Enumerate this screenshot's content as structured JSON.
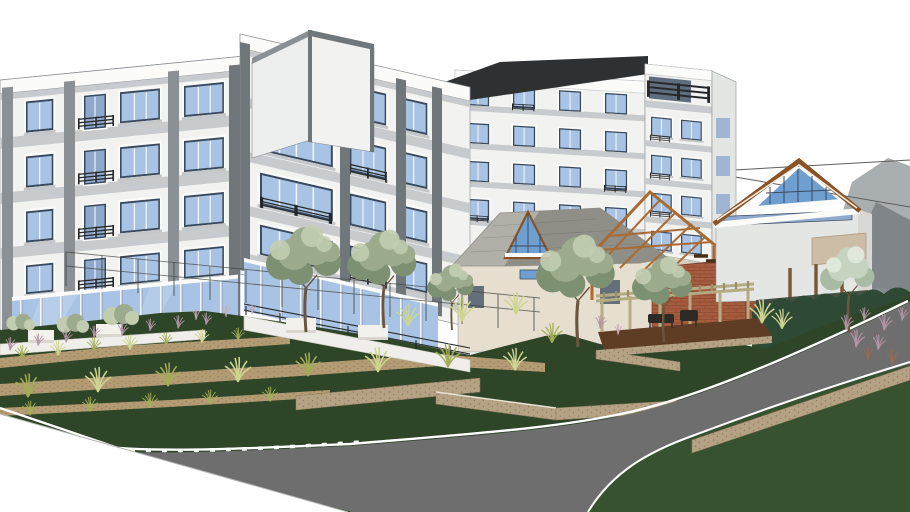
{
  "meta": {
    "title": "3D architectural rendering of a five-story apartment complex with landscaped terraces, clubhouse, pergola deck and curving access road",
    "canvas": {
      "width": 910,
      "height": 512
    }
  },
  "scene": {
    "description": "SketchUp-style exterior visualization on a white background: a white five-story apartment building with gray pilasters, blue glazing and balconies; a rear wing with dark flat roof and corner balcony unit; ground-floor glass storefront; gray-roofed clubhouse with glazed gable; open timber pavilion trusses; brick wall with white box volume; gabled guest house with glazed gable; terraced lawns with mulch planting beds, ornamental grasses, olive trees, stone retaining walls; a curving asphalt road with white curbs; power lines and distant mountains at right.",
    "objects": [
      {
        "name": "apartment-building",
        "description": "White 5-story block, gray pilasters, blue windows, balconies"
      },
      {
        "name": "stair-tower",
        "description": "Taller white tower with dark cap trim"
      },
      {
        "name": "rear-wing",
        "description": "Rear wing with near-black flat roof"
      },
      {
        "name": "corner-unit",
        "description": "Right corner unit with wrap balcony"
      },
      {
        "name": "storefront-glazing",
        "description": "Blue glass curtain wall at ground floor"
      },
      {
        "name": "clubhouse",
        "description": "Single-story clubhouse, gray shingle roof, glazed gable"
      },
      {
        "name": "pavilion-trusses",
        "description": "Open gable frame of orange-brown rafters"
      },
      {
        "name": "brick-wall",
        "description": "Red-brown brick mass with steps"
      },
      {
        "name": "white-box",
        "description": "Untextured white cube volume"
      },
      {
        "name": "guest-house",
        "description": "Gabled house with glazed gable and timber fascia"
      },
      {
        "name": "pergola-deck",
        "description": "Timber pergola over dark wood deck with furniture"
      },
      {
        "name": "hedge",
        "description": "Dark green clipped hedge row"
      },
      {
        "name": "terraces",
        "description": "Lawn terraces with tan mulch bands and grass tufts"
      },
      {
        "name": "retaining-walls",
        "description": "Tan stone retaining walls"
      },
      {
        "name": "road",
        "description": "Curving gray asphalt road with white curb lines"
      },
      {
        "name": "trees",
        "description": "Olive-green and silver ornamental trees"
      },
      {
        "name": "mountains",
        "description": "Faint gray mountains, background right"
      },
      {
        "name": "power-lines",
        "description": "Thin overhead wires crossing upper right"
      }
    ]
  },
  "palette": {
    "canvas": "#ffffff",
    "mountainFar": "#9aa0a2",
    "mountainNear": "#7a8184",
    "wire": "#5d5d5d",
    "wallWhite": "#f2f2f0",
    "wallShade": "#e4e6e4",
    "wallReturn": "#ecefee",
    "parapet": "#fbfbfa",
    "winSurround": "#fafaf8",
    "slabGray": "#c7cbcd",
    "pilaster": "#8b9094",
    "pilasterDark": "#70777b",
    "frameDark": "#3a4a5e",
    "glassBlue": "#a9c3e4",
    "glassDoor": "#8fa9cc",
    "glassGable": "#6f9fd0",
    "mullionWhite": "#f4f6f8",
    "sill": "#c4c8ca",
    "railDark": "#24282b",
    "roofDark": "#2f3032",
    "slateLight": "#b0afa8",
    "slateDark": "#8f8e87",
    "beigeWall": "#e6dfcf",
    "beigeShade": "#d4ccba",
    "fasciaBrown": "#8a5326",
    "rafterBrown": "#a96a33",
    "brick": "#a65c3e",
    "brickDark": "#8c4a31",
    "stepBrown": "#4a2d18",
    "boxWhite": "#ffffff",
    "boxShade": "#ececea",
    "tanPanel": "#d8c6ae",
    "deckTan": "#cdbda6",
    "timber": "#b5ab82",
    "timberDark": "#9a8f66",
    "deckBrown": "#5f3d24",
    "furniture": "#2e2a26",
    "postBrown": "#7a5a38",
    "underDeck": "#3c4a3c",
    "hedge": "#2e4a34",
    "lawnDark": "#2e4528",
    "lawnMid": "#37522e",
    "mulch": "#b39c74",
    "mulchDark": "#8f7a57",
    "stoneWall": "#b5a284",
    "stoneShadow": "#8f7c5e",
    "stoneCap": "#e8e2d4",
    "road": "#6e6e6e",
    "curb": "#ffffff",
    "terraceWhite": "#efeeea",
    "planterWhite": "#f2f1ec",
    "planterShade": "#d8d6cf",
    "treeOlive": "#9cab8c",
    "treeOliveDark": "#7e9072",
    "treeOliveLight": "#c2cdb0",
    "treeSilver": "#c6d3c0",
    "treeSilverDark": "#a9bba4",
    "treeSilverLight": "#e2e9da",
    "trunk": "#6b5540",
    "tuftGreen": "#a3ad58",
    "tuftLight": "#cdd490",
    "tuftRust": "#9a6a52",
    "purpleGrass": "#b294a4",
    "pinkGrass": "#c9a9b4",
    "outline": "#8a8e90"
  }
}
